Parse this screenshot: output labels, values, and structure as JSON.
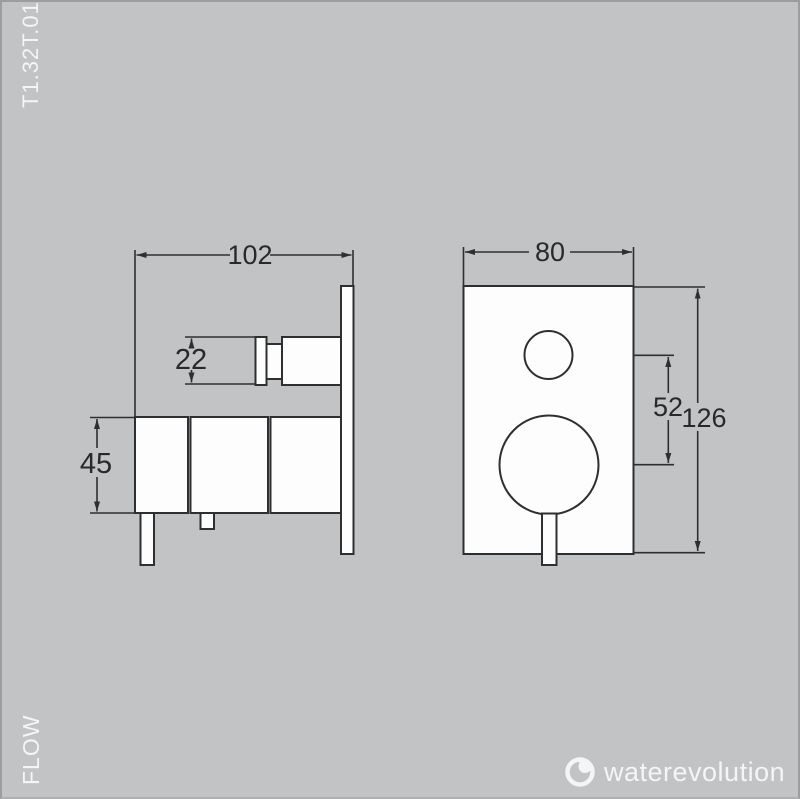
{
  "sheet": {
    "product_code": "T1.32T.01",
    "flow_label": "FLOW",
    "brand_name": "waterevolution"
  },
  "dimensions": {
    "side_view": {
      "total_depth": "102",
      "knob_diameter": "22",
      "body_height": "45"
    },
    "front_view": {
      "plate_width": "80",
      "control_spacing": "52",
      "plate_height": "126"
    }
  },
  "colors": {
    "background": "#c1c3c5",
    "line": "#2d2f31",
    "part_fill": "#fdfdfe",
    "light_text": "#f4f5f6",
    "dim_text": "#28292b"
  }
}
